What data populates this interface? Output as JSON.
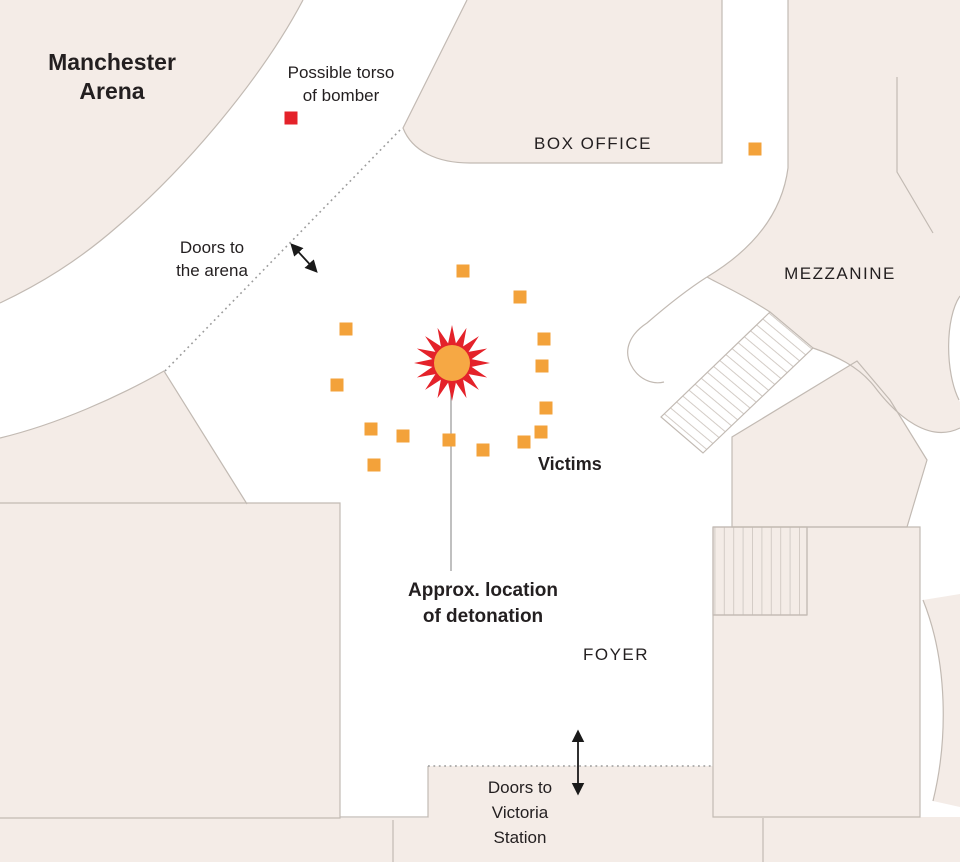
{
  "title": {
    "line1": "Manchester",
    "line2": "Arena"
  },
  "rooms": {
    "box_office": "BOX OFFICE",
    "mezzanine": "MEZZANINE",
    "foyer": "FOYER"
  },
  "annotations": {
    "torso_line1": "Possible torso",
    "torso_line2": "of bomber",
    "doors_arena_line1": "Doors to",
    "doors_arena_line2": "the arena",
    "victims_label": "Victims",
    "detonation_line1": "Approx. location",
    "detonation_line2": "of detonation",
    "doors_victoria_line1": "Doors to",
    "doors_victoria_line2": "Victoria",
    "doors_victoria_line3": "Station"
  },
  "colors": {
    "room_fill": "#F4ECE7",
    "wall": "#C2BAB3",
    "stair_hatch": "#D3CCC6",
    "victim": "#F3A23A",
    "bomber": "#E4222A",
    "blast_outer": "#E4222A",
    "blast_inner": "#F6A844",
    "dotted_line": "#9C9C9C",
    "leader_line": "#ABABAB",
    "arrow": "#1A1A1A",
    "text": "#231F20"
  },
  "markers": {
    "detonation": {
      "x": 452,
      "y": 363
    },
    "torso": {
      "x": 291,
      "y": 118
    },
    "victims": [
      {
        "x": 463,
        "y": 271
      },
      {
        "x": 520,
        "y": 297
      },
      {
        "x": 346,
        "y": 329
      },
      {
        "x": 544,
        "y": 339
      },
      {
        "x": 542,
        "y": 366
      },
      {
        "x": 337,
        "y": 385
      },
      {
        "x": 546,
        "y": 408
      },
      {
        "x": 371,
        "y": 429
      },
      {
        "x": 403,
        "y": 436
      },
      {
        "x": 449,
        "y": 440
      },
      {
        "x": 541,
        "y": 432
      },
      {
        "x": 524,
        "y": 442
      },
      {
        "x": 483,
        "y": 450
      },
      {
        "x": 374,
        "y": 465
      },
      {
        "x": 755,
        "y": 149
      }
    ]
  }
}
